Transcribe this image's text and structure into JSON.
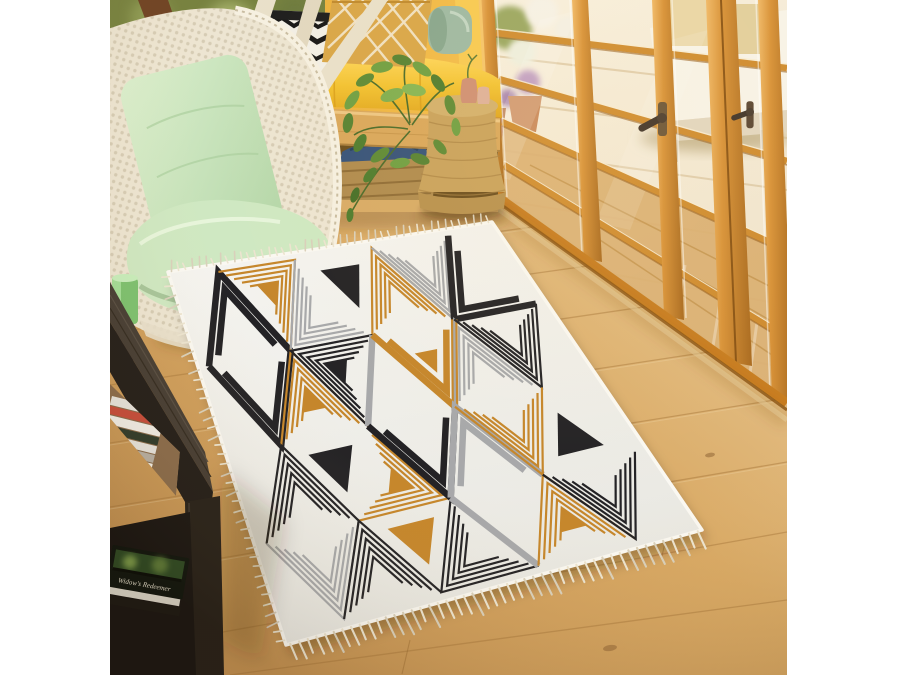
{
  "scene": {
    "description": "Sunlit room: geometric fringed area rug on oak floor, macrame hanging chair, yellow window bench, plant on rope stool, orange french doors to terrace, dark side table with books",
    "book_title": "Widow's Redeemer",
    "objects": [
      "hanging-macrame-chair",
      "window-bench",
      "throw-pillows",
      "potted-plant",
      "rope-stool",
      "french-doors",
      "terrace-daybed",
      "oak-floor",
      "dark-side-table",
      "books",
      "geometric-rug"
    ]
  },
  "palette": {
    "rug_black": "#232225",
    "rug_gold": "#c5862b",
    "rug_gray": "#a7a8aa",
    "rug_base": "#efeee9",
    "fringe_light": "#ece4d0",
    "fringe_dark": "#d9d0bb",
    "floor_mid": "#d9a964",
    "wall_yellow": "#edab31",
    "door_orange": "#cf8c30",
    "cushion_yellow": "#f2c231",
    "cushion_mint": "#cfe8c2",
    "bolster_sage": "#9db9a4",
    "table_dark": "#241f1b",
    "plant_green": "#6a9a3f"
  },
  "rug": {
    "quad": [
      [
        58,
        272
      ],
      [
        382,
        222
      ],
      [
        592,
        530
      ],
      [
        176,
        645
      ]
    ],
    "inset": [
      0.03,
      0.02,
      0.94,
      0.955
    ],
    "grid_cols": 7,
    "grid_rows": 4,
    "rows": [
      [
        "T:K:a",
        "L:G:r:s",
        "L:A:l",
        "S:K",
        "L:G:a",
        "L:A:a",
        "T:K:l"
      ],
      [
        "T:K:a",
        "L:G:a:s",
        "L:K:l:s",
        "T:A:a:1",
        "T:G:a:s",
        "L:A:a",
        "L:K:a"
      ],
      [
        "L:K:a",
        "S:K",
        "L:G:r:s",
        "T:K:a",
        "T:A:a",
        "L:G:a",
        "S:K"
      ],
      [
        "L:A:a",
        "L:K:a",
        "S:G",
        "L:K:l",
        "T:A:a:1",
        "L:G:a:s",
        "L:K:a"
      ]
    ],
    "colors": {
      "K": "rug_black",
      "G": "rug_gold",
      "A": "rug_gray"
    },
    "line_width": 2.2,
    "thick_width": 6.5,
    "fringe": {
      "top": {
        "n": 46,
        "len": 9,
        "w": 1.6,
        "sign": -1
      },
      "bottom": {
        "n": 48,
        "len": 19,
        "w": 2.1,
        "sign": 1
      },
      "left": {
        "n": 40,
        "len": 10,
        "w": 1.7,
        "sign": 1
      }
    }
  }
}
